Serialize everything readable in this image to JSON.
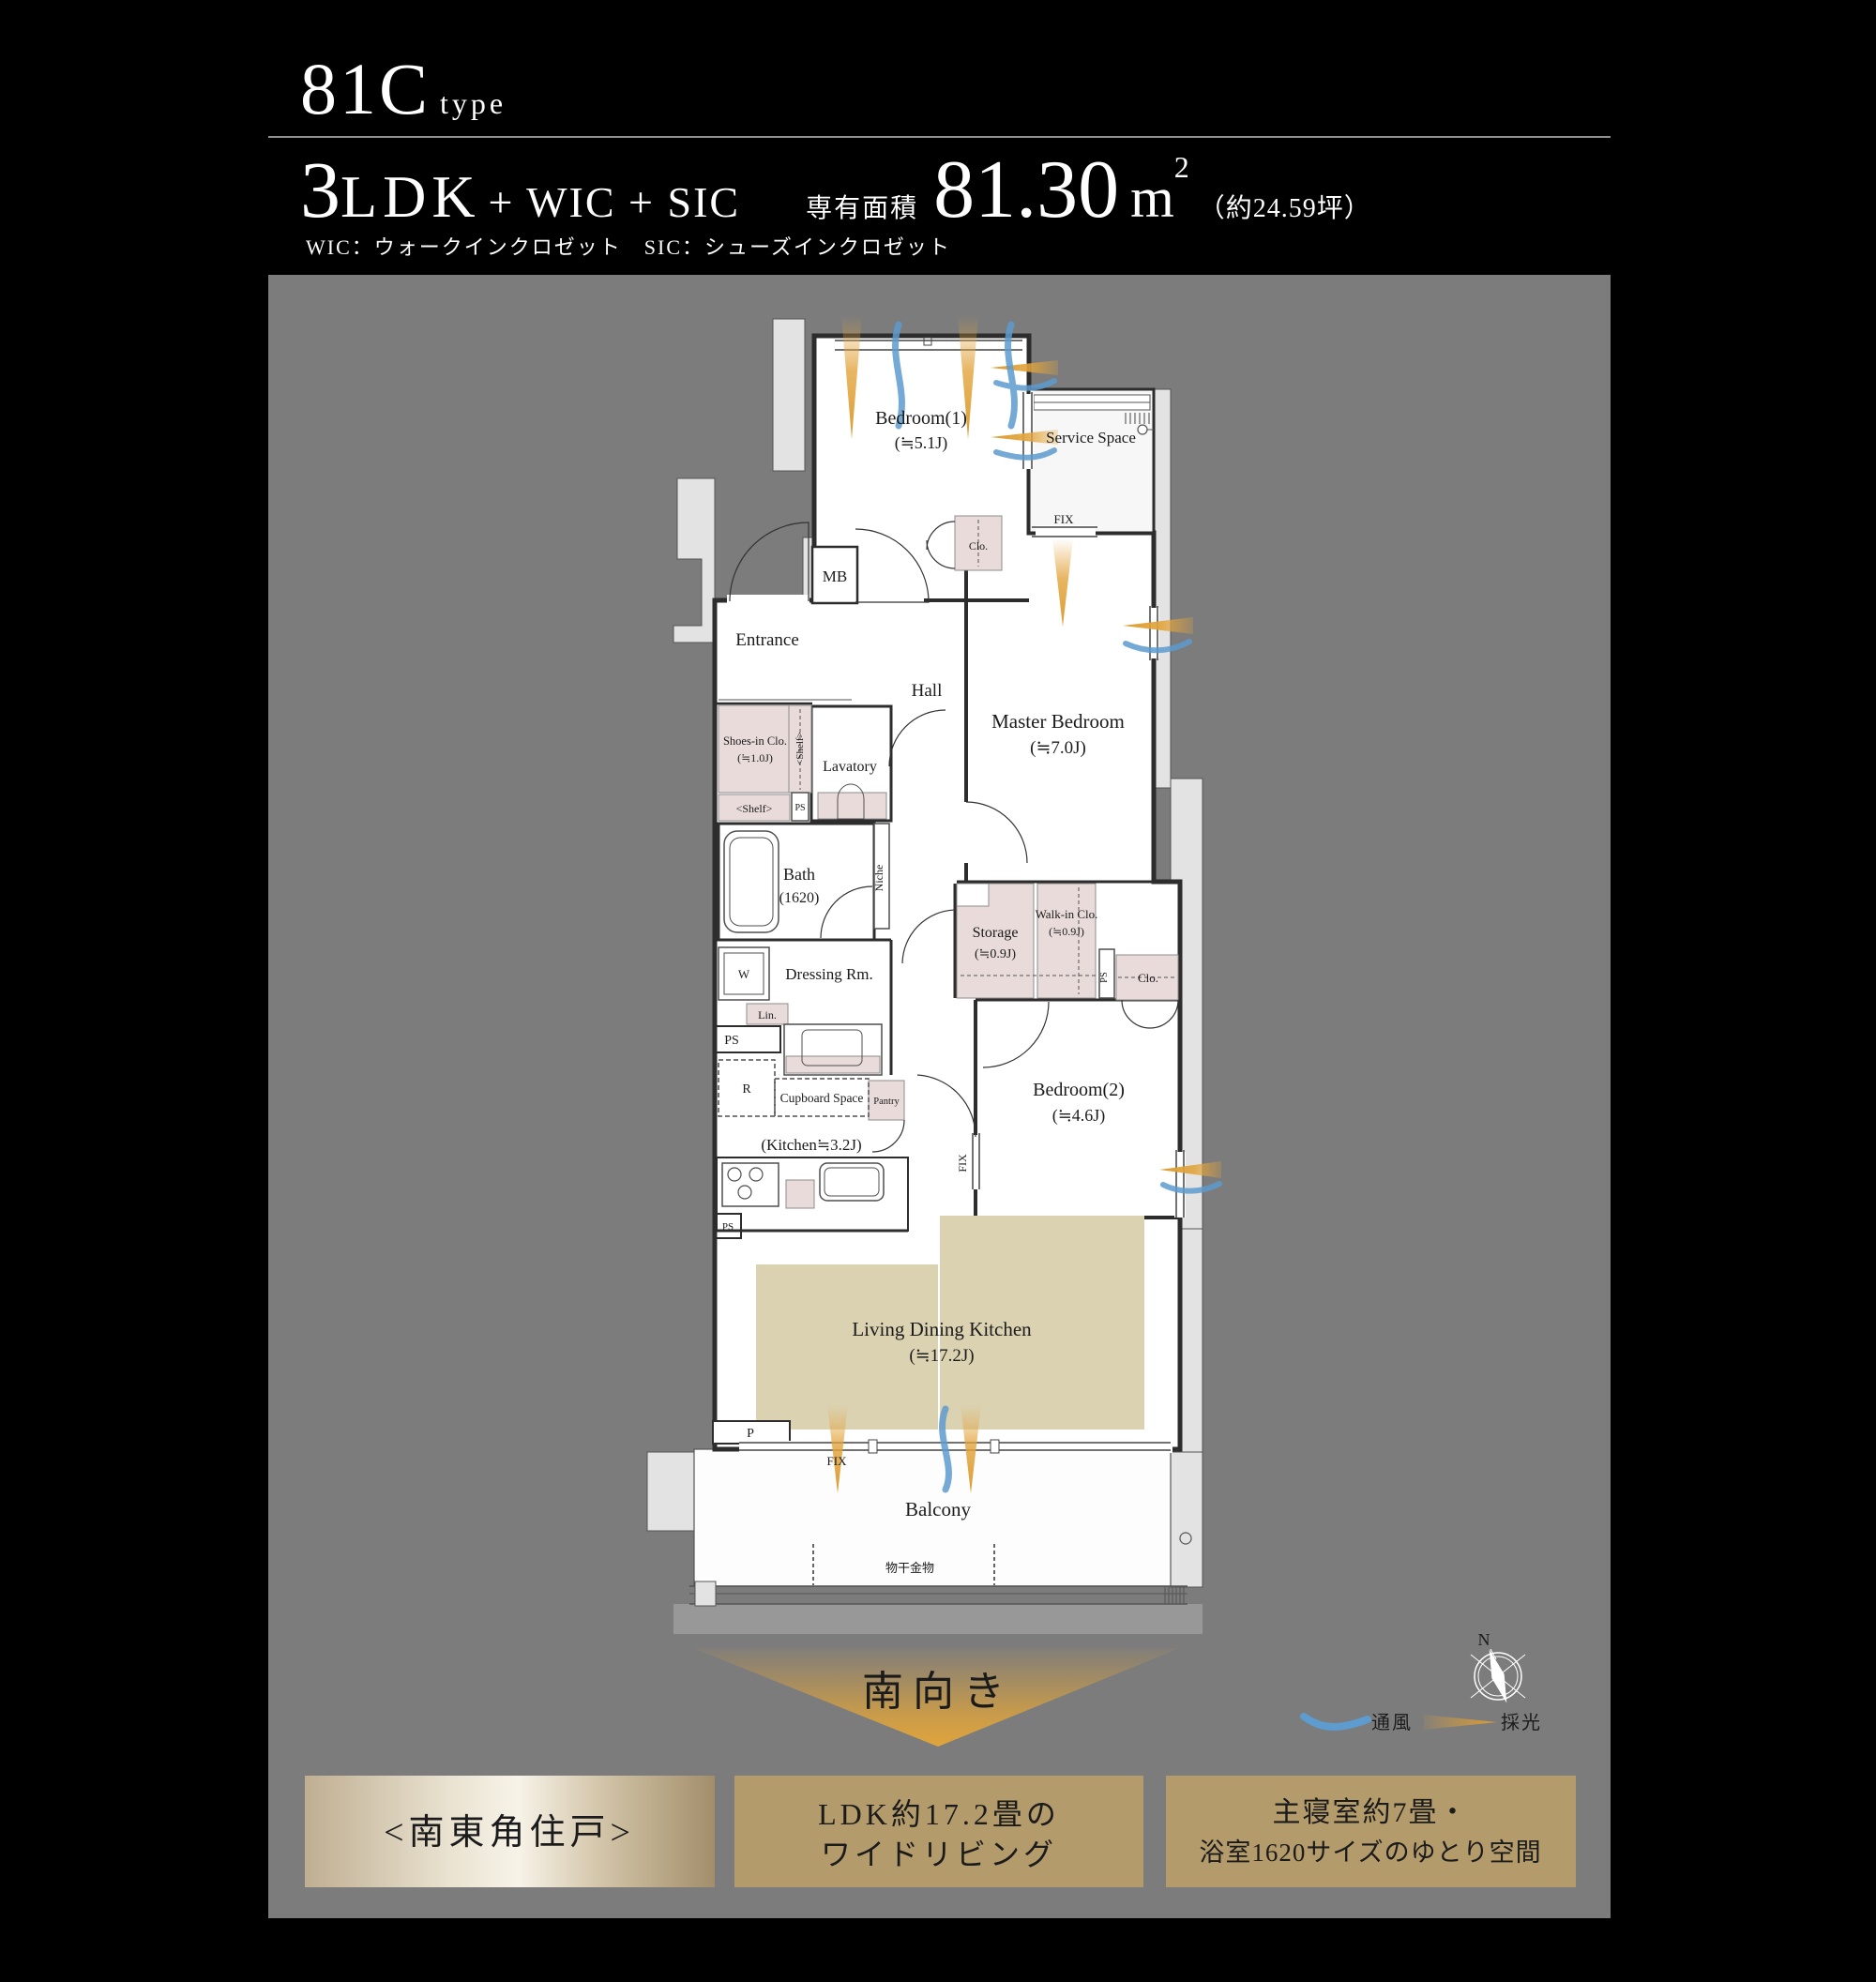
{
  "header": {
    "unit_code": "81C",
    "unit_code_suffix": "type",
    "layout_number": "3",
    "layout_letters": "LDK",
    "layout_additions": " + WIC + SIC",
    "abbreviation_note": "WIC：ウォークインクロゼット　SIC：シューズインクロゼット",
    "area_label": "専有面積",
    "area_value": "81.30",
    "area_unit": "m",
    "area_unit_sup": "2",
    "area_tsubo": "（約24.59坪）"
  },
  "plan": {
    "rooms": {
      "bedroom1": {
        "name": "Bedroom(1)",
        "size": "(≒5.1J)"
      },
      "service_space": {
        "name": "Service Space"
      },
      "mb": {
        "name": "MB"
      },
      "clo_bedroom1": {
        "name": "Clo."
      },
      "entrance": {
        "name": "Entrance"
      },
      "hall": {
        "name": "Hall"
      },
      "master_bedroom": {
        "name": "Master Bedroom",
        "size": "(≒7.0J)"
      },
      "shoes_in_clo": {
        "name": "Shoes-in Clo.",
        "size": "(≒1.0J)"
      },
      "shelf_vertical": {
        "name": "<Shelf>"
      },
      "shelf_horizontal": {
        "name": "<Shelf>"
      },
      "ps_entrance": {
        "name": "PS"
      },
      "lavatory": {
        "name": "Lavatory"
      },
      "bath": {
        "name": "Bath",
        "size": "(1620)"
      },
      "niche": {
        "name": "Niche"
      },
      "washer": {
        "name": "W"
      },
      "dressing_room": {
        "name": "Dressing Rm."
      },
      "linen": {
        "name": "Lin."
      },
      "ps_mid": {
        "name": "PS"
      },
      "refrigerator": {
        "name": "R"
      },
      "cupboard_space": {
        "name": "Cupboard Space"
      },
      "pantry": {
        "name": "Pantry"
      },
      "kitchen": {
        "name": "(Kitchen≒3.2J)"
      },
      "storage": {
        "name": "Storage",
        "size": "(≒0.9J)"
      },
      "walk_in_clo": {
        "name": "Walk-in Clo.",
        "size": "(≒0.9J)"
      },
      "ps_walkin": {
        "name": "PS"
      },
      "clo_bedroom2": {
        "name": "Clo."
      },
      "bedroom2": {
        "name": "Bedroom(2)",
        "size": "(≒4.6J)"
      },
      "ps_ldk": {
        "name": "PS"
      },
      "p_box": {
        "name": "P"
      },
      "ldk": {
        "name": "Living Dining Kitchen",
        "size": "(≒17.2J)"
      },
      "balcony": {
        "name": "Balcony"
      },
      "drying_hardware": {
        "name": "物干金物"
      }
    },
    "window_labels": {
      "fix_service": "FIX",
      "fix_bedroom2": "FIX",
      "fix_ldk": "FIX"
    }
  },
  "footer": {
    "direction": "南向き",
    "compass_north": "N",
    "legend": {
      "ventilation": "通風",
      "daylight": "採光"
    },
    "highlight_boxes": [
      {
        "line1": "<南東角住戸>",
        "line2": ""
      },
      {
        "line1": "LDK約17.2畳の",
        "line2": "ワイドリビング"
      },
      {
        "line1": "主寝室約7畳・",
        "line2": "浴室1620サイズのゆとり空間"
      }
    ]
  },
  "colors": {
    "background": "#000000",
    "panel_gray": "#7c7c7c",
    "daylight_gold": "#e2a43c",
    "ventilation_blue": "#5e9bcf",
    "closet_pink": "#e9dbda",
    "rug_beige": "#dbd2b2",
    "box_tan": "#b49b6b"
  }
}
